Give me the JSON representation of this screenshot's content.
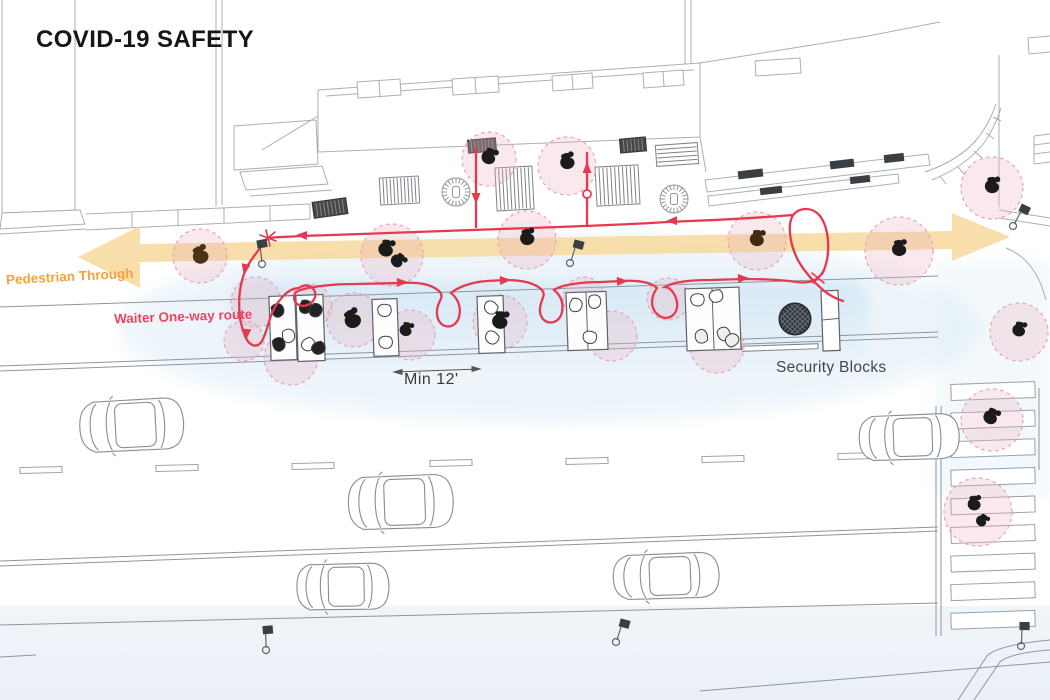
{
  "title": "COVID-19 SAFETY",
  "labels": {
    "pedestrian_through": "Pedestrian Through",
    "waiter_route": "Waiter One-way route",
    "min_spacing": "Min 12'",
    "security_blocks": "Security Blocks"
  },
  "colors": {
    "route_red": "#E53950",
    "arrow_orange": "#F6DCA4",
    "label_orange": "#F2A23B",
    "label_red": "#E94560",
    "distance_fill": "rgba(236,178,193,0.30)",
    "distance_stroke": "#E4A4B8",
    "dining_blue": "#D4E7F5",
    "line_gray": "#A9AFB5",
    "ink": "#1b1b1b"
  },
  "diagram": {
    "people": [
      {
        "x": 200,
        "y": 255,
        "rot": -20,
        "s": 1.2,
        "c": "#4a3316"
      },
      {
        "x": 386,
        "y": 248,
        "rot": 15,
        "s": 1.15,
        "c": "#1b1b1b"
      },
      {
        "x": 398,
        "y": 260,
        "rot": 50,
        "s": 1.0,
        "c": "#1b1b1b"
      },
      {
        "x": 527,
        "y": 237,
        "rot": -5,
        "s": 1.1,
        "c": "#1b1b1b"
      },
      {
        "x": 757,
        "y": 238,
        "rot": 10,
        "s": 1.1,
        "c": "#3f2c12"
      },
      {
        "x": 899,
        "y": 248,
        "rot": 0,
        "s": 1.1,
        "c": "#1b1b1b"
      },
      {
        "x": 489,
        "y": 156,
        "rot": 25,
        "s": 1.1,
        "c": "#1b1b1b"
      },
      {
        "x": 567,
        "y": 161,
        "rot": -10,
        "s": 1.1,
        "c": "#1b1b1b"
      },
      {
        "x": 992,
        "y": 185,
        "rot": 5,
        "s": 1.1,
        "c": "#1b1b1b"
      },
      {
        "x": 1019,
        "y": 329,
        "rot": 15,
        "s": 1.0,
        "c": "#1b1b1b"
      },
      {
        "x": 991,
        "y": 416,
        "rot": 30,
        "s": 1.1,
        "c": "#1b1b1b"
      },
      {
        "x": 974,
        "y": 503,
        "rot": 0,
        "s": 1.0,
        "c": "#1b1b1b"
      },
      {
        "x": 982,
        "y": 520,
        "rot": 40,
        "s": 0.85,
        "c": "#1b1b1b"
      },
      {
        "x": 352,
        "y": 319,
        "rot": -25,
        "s": 1.25,
        "c": "#1b1b1b"
      },
      {
        "x": 406,
        "y": 329,
        "rot": 20,
        "s": 0.95,
        "c": "#1b1b1b"
      },
      {
        "x": 500,
        "y": 320,
        "rot": 10,
        "s": 1.2,
        "c": "#1b1b1b"
      }
    ],
    "distance_circles": [
      {
        "x": 200,
        "y": 256,
        "r": 27
      },
      {
        "x": 392,
        "y": 255,
        "r": 31
      },
      {
        "x": 527,
        "y": 240,
        "r": 29
      },
      {
        "x": 757,
        "y": 241,
        "r": 29
      },
      {
        "x": 899,
        "y": 251,
        "r": 34
      },
      {
        "x": 992,
        "y": 188,
        "r": 31
      },
      {
        "x": 1019,
        "y": 332,
        "r": 29
      },
      {
        "x": 992,
        "y": 420,
        "r": 31
      },
      {
        "x": 978,
        "y": 512,
        "r": 34
      },
      {
        "x": 489,
        "y": 159,
        "r": 27
      },
      {
        "x": 567,
        "y": 166,
        "r": 29
      },
      {
        "x": 256,
        "y": 302,
        "r": 25
      },
      {
        "x": 291,
        "y": 358,
        "r": 27
      },
      {
        "x": 244,
        "y": 341,
        "r": 20
      },
      {
        "x": 354,
        "y": 320,
        "r": 27
      },
      {
        "x": 410,
        "y": 335,
        "r": 25
      },
      {
        "x": 500,
        "y": 322,
        "r": 27
      },
      {
        "x": 584,
        "y": 298,
        "r": 21
      },
      {
        "x": 612,
        "y": 336,
        "r": 25
      },
      {
        "x": 668,
        "y": 299,
        "r": 21
      },
      {
        "x": 717,
        "y": 346,
        "r": 27
      },
      {
        "x": 310,
        "y": 306,
        "r": 22
      }
    ],
    "tables": [
      {
        "x": 270,
        "y": 296,
        "w": 26,
        "h": 64,
        "chairs": [
          {
            "dx": 9,
            "dy": 14,
            "f": "#222"
          },
          {
            "dx": 19,
            "dy": 40,
            "f": "#fff"
          },
          {
            "dx": 9,
            "dy": 48,
            "f": "#222"
          }
        ]
      },
      {
        "x": 297,
        "y": 295,
        "w": 27,
        "h": 66,
        "chairs": [
          {
            "dx": 10,
            "dy": 12,
            "f": "#222"
          },
          {
            "dx": 20,
            "dy": 16,
            "f": "#222"
          },
          {
            "dx": 11,
            "dy": 50,
            "f": "#fff"
          },
          {
            "dx": 21,
            "dy": 54,
            "f": "#222"
          }
        ]
      },
      {
        "x": 373,
        "y": 299,
        "w": 25,
        "h": 57,
        "chairs": [
          {
            "dx": 12,
            "dy": 12,
            "f": "#fff"
          },
          {
            "dx": 12,
            "dy": 44,
            "f": "#fff"
          }
        ]
      },
      {
        "x": 478,
        "y": 296,
        "w": 26,
        "h": 57,
        "chairs": [
          {
            "dx": 13,
            "dy": 12,
            "f": "#fff"
          },
          {
            "dx": 13,
            "dy": 42,
            "f": "#fff"
          }
        ]
      },
      {
        "x": 567,
        "y": 292,
        "w": 40,
        "h": 58,
        "div": 20,
        "chairs": [
          {
            "dx": 10,
            "dy": 13,
            "f": "#fff"
          },
          {
            "dx": 29,
            "dy": 10,
            "f": "#fff"
          },
          {
            "dx": 22,
            "dy": 46,
            "f": "#fff"
          }
        ]
      },
      {
        "x": 686,
        "y": 288,
        "w": 54,
        "h": 62,
        "div": 27,
        "chairs": [
          {
            "dx": 12,
            "dy": 12,
            "f": "#fff"
          },
          {
            "dx": 31,
            "dy": 9,
            "f": "#fff"
          },
          {
            "dx": 14,
            "dy": 48,
            "f": "#eee"
          },
          {
            "dx": 38,
            "dy": 46,
            "f": "#eee"
          },
          {
            "dx": 45,
            "dy": 52,
            "f": "#eee"
          }
        ]
      }
    ],
    "cars": [
      {
        "x": 78,
        "y": 402,
        "w": 106,
        "h": 52,
        "rot": -3
      },
      {
        "x": 347,
        "y": 477,
        "w": 107,
        "h": 54,
        "rot": -2
      },
      {
        "x": 296,
        "y": 564,
        "w": 94,
        "h": 47,
        "rot": -1
      },
      {
        "x": 612,
        "y": 555,
        "w": 108,
        "h": 46,
        "rot": -2
      },
      {
        "x": 858,
        "y": 416,
        "w": 102,
        "h": 46,
        "rot": -2
      }
    ],
    "lane_dashes": [
      {
        "x": 20,
        "y": 467
      },
      {
        "x": 156,
        "y": 465
      },
      {
        "x": 292,
        "y": 463
      },
      {
        "x": 430,
        "y": 460
      },
      {
        "x": 566,
        "y": 458
      },
      {
        "x": 702,
        "y": 456
      },
      {
        "x": 838,
        "y": 453
      }
    ],
    "crosswalk": {
      "x": 951,
      "y": 383,
      "w": 84,
      "h": 16,
      "count": 9,
      "pitch": 28.6,
      "rot": -2
    },
    "tree_grates": [
      {
        "x": 456,
        "y": 192
      },
      {
        "x": 674,
        "y": 199
      }
    ],
    "hatches": [
      {
        "x": 380,
        "y": 177,
        "w": 39,
        "h": 27,
        "n": 10,
        "dir": "v",
        "dark": false,
        "rot": -3
      },
      {
        "x": 496,
        "y": 167,
        "w": 37,
        "h": 43,
        "n": 9,
        "dir": "v",
        "dark": false,
        "rot": -3
      },
      {
        "x": 596,
        "y": 166,
        "w": 43,
        "h": 39,
        "n": 10,
        "dir": "v",
        "dark": false,
        "rot": -3
      },
      {
        "x": 656,
        "y": 144,
        "w": 42,
        "h": 21,
        "n": 4,
        "dir": "h",
        "dark": false,
        "rot": -4
      },
      {
        "x": 313,
        "y": 200,
        "w": 34,
        "h": 16,
        "n": 8,
        "dir": "v",
        "dark": true,
        "rot": -8
      },
      {
        "x": 468,
        "y": 139,
        "w": 28,
        "h": 13,
        "n": 7,
        "dir": "v",
        "dark": true,
        "rot": -5
      },
      {
        "x": 620,
        "y": 138,
        "w": 26,
        "h": 14,
        "n": 6,
        "dir": "v",
        "dark": true,
        "rot": -5
      },
      {
        "x": 742,
        "y": 345,
        "w": 76,
        "h": 5,
        "n": 0,
        "dir": "h",
        "dark": false,
        "rot": -2
      }
    ],
    "meters": [
      {
        "x": 262,
        "y": 264,
        "rot": -25
      },
      {
        "x": 570,
        "y": 263,
        "rot": 0
      },
      {
        "x": 266,
        "y": 650,
        "rot": -20
      },
      {
        "x": 616,
        "y": 642,
        "rot": 0
      },
      {
        "x": 1013,
        "y": 226,
        "rot": 10
      },
      {
        "x": 1021,
        "y": 646,
        "rot": -15
      }
    ],
    "route_arrows": [
      {
        "x": 407,
        "y": 282,
        "a": -3
      },
      {
        "x": 510,
        "y": 280,
        "a": -3
      },
      {
        "x": 627,
        "y": 281,
        "a": -2
      },
      {
        "x": 748,
        "y": 278,
        "a": -3
      },
      {
        "x": 667,
        "y": 221,
        "a": 178
      },
      {
        "x": 297,
        "y": 235,
        "a": 183
      },
      {
        "x": 244,
        "y": 274,
        "a": 102
      },
      {
        "x": 246,
        "y": 339,
        "a": 95
      },
      {
        "x": 476,
        "y": 203,
        "a": 90
      },
      {
        "x": 587,
        "y": 163,
        "a": -90
      }
    ],
    "security": {
      "circle": {
        "x": 795,
        "y": 319,
        "r": 16
      },
      "block": {
        "x": 821,
        "y": 291,
        "w": 17,
        "h": 60
      }
    }
  }
}
